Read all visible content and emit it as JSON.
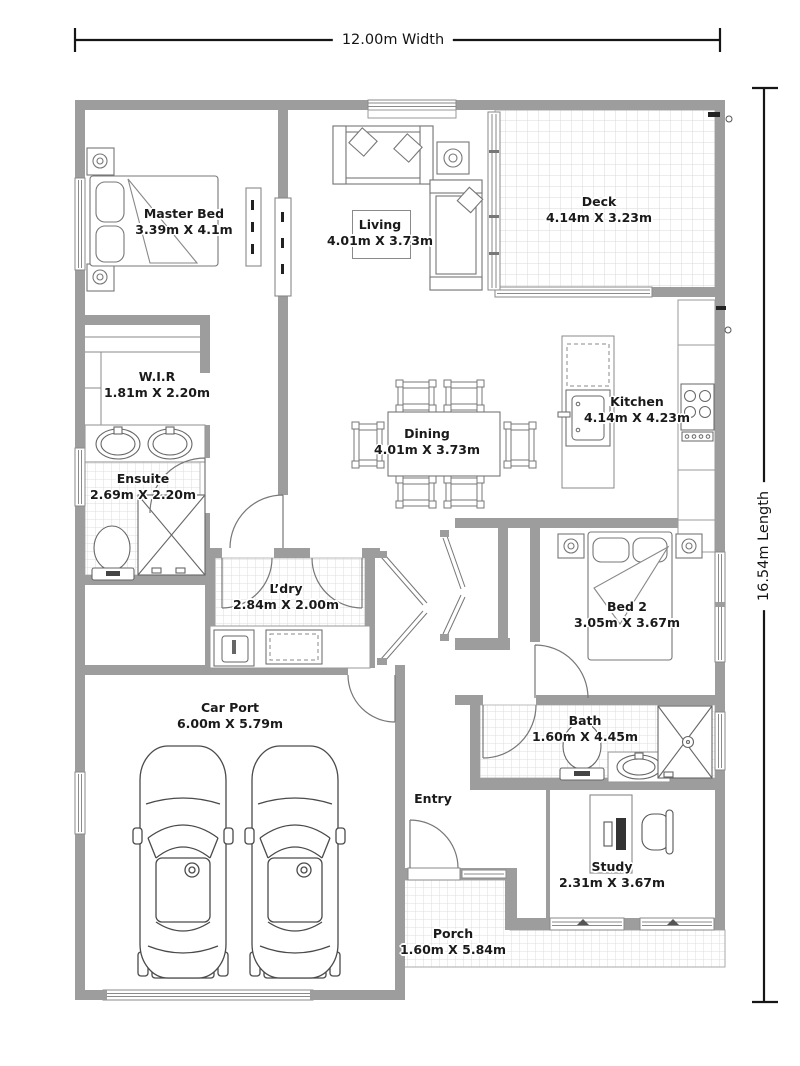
{
  "plan": {
    "width_label": "12.00m Width",
    "length_label": "16.54m Length"
  },
  "rooms": {
    "master_bed": {
      "name": "Master Bed",
      "dims": "3.39m X 4.1m"
    },
    "living": {
      "name": "Living",
      "dims": "4.01m X 3.73m"
    },
    "deck": {
      "name": "Deck",
      "dims": "4.14m X 3.23m"
    },
    "wir": {
      "name": "W.I.R",
      "dims": "1.81m X 2.20m"
    },
    "ensuite": {
      "name": "Ensuite",
      "dims": "2.69m X 2.20m"
    },
    "dining": {
      "name": "Dining",
      "dims": "4.01m X 3.73m"
    },
    "kitchen": {
      "name": "Kitchen",
      "dims": "4.14m X 4.23m"
    },
    "ldry": {
      "name": "L’dry",
      "dims": "2.84m X 2.00m"
    },
    "bed2": {
      "name": "Bed 2",
      "dims": "3.05m X 3.67m"
    },
    "car_port": {
      "name": "Car Port",
      "dims": "6.00m X 5.79m"
    },
    "bath": {
      "name": "Bath",
      "dims": "1.60m X 4.45m"
    },
    "entry": {
      "name": "Entry",
      "dims": ""
    },
    "study": {
      "name": "Study",
      "dims": "2.31m X 3.67m"
    },
    "porch": {
      "name": "Porch",
      "dims": "1.60m X 5.84m"
    }
  },
  "colors": {
    "wall": "#9d9d9d",
    "fixture_line": "#666666",
    "tile_line": "#d8d8d8",
    "dimension_line": "#161616",
    "text": "#1a1a1a",
    "background": "#ffffff"
  }
}
